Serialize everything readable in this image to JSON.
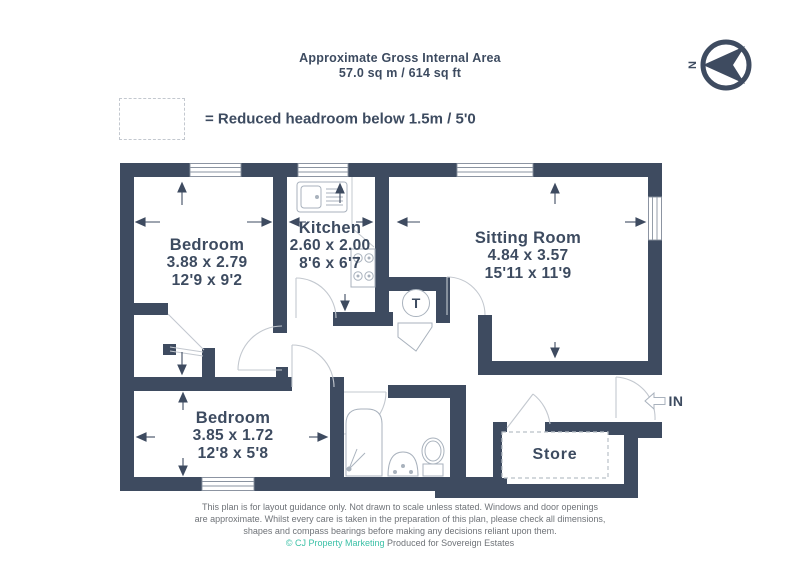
{
  "header": {
    "title": "Approximate Gross Internal Area",
    "area": "57.0 sq m / 614 sq ft"
  },
  "legend": {
    "text": "= Reduced headroom below 1.5m / 5'0"
  },
  "compass": {
    "north_label": "N"
  },
  "entrance": {
    "label": "IN"
  },
  "plan": {
    "rooms": [
      {
        "name": "Bedroom",
        "metric": "3.88 x 2.79",
        "imperial": "12'9 x 9'2"
      },
      {
        "name": "Kitchen",
        "metric": "2.60 x 2.00",
        "imperial": "8'6 x 6'7"
      },
      {
        "name": "Sitting Room",
        "metric": "4.84 x 3.57",
        "imperial": "15'11 x 11'9"
      },
      {
        "name": "Bedroom",
        "metric": "3.85 x 1.72",
        "imperial": "12'8 x 5'8"
      },
      {
        "name": "Store",
        "metric": "",
        "imperial": ""
      }
    ],
    "tank_label": "T"
  },
  "footer": {
    "line1": "This plan is for layout guidance only. Not drawn to scale unless stated. Windows and door openings",
    "line2": "are approximate. Whilst every care is taken in the preparation of this plan, please check all dimensions,",
    "line3": "shapes and compass bearings before making any decisions reliant upon them.",
    "credit": "© CJ Property Marketing",
    "produced": "Produced for Sovereign Estates"
  },
  "colors": {
    "wall": "#3e4b60",
    "text": "#3d4b60",
    "fixture_line": "#a9b2bd",
    "door_line": "#c3c8cf",
    "window_line": "#8a93a0",
    "credit_teal": "#3cc1a7",
    "footer_gray": "#6f7378"
  }
}
